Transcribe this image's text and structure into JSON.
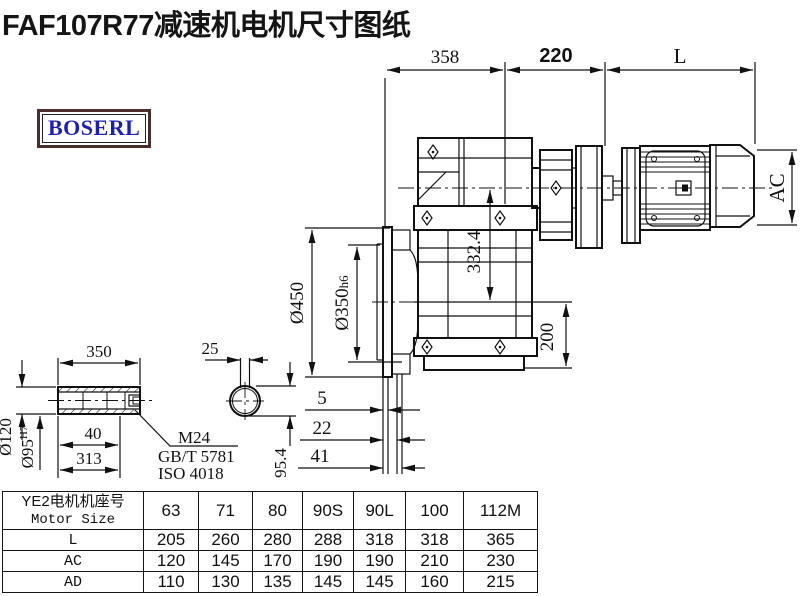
{
  "title": "FAF107R77减速机电机尺寸图纸",
  "logo": "BOSERL",
  "drawing": {
    "dims": {
      "top_width": "358",
      "top_mid": "220",
      "motor_len": "L",
      "motor_od": "AC",
      "axis_dist": "332.4",
      "base_height": "200",
      "flange_od": "Ø450",
      "spigot_base": "Ø350",
      "spigot_tol": "h6",
      "stack": [
        "5",
        "22",
        "41"
      ]
    },
    "shaft": {
      "length": "350",
      "key_width": "25",
      "od": "Ø120",
      "bore_base": "Ø95",
      "bore_tol": "H7",
      "dim40": "40",
      "dim313": "313",
      "key_dim": "95.4",
      "thread": "M24",
      "std_gb": "GB/T 5781",
      "std_iso": "ISO 4018"
    }
  },
  "table": {
    "header": {
      "line1": "YE2电机机座号",
      "line2": "Motor Size"
    },
    "columns": [
      "63",
      "71",
      "80",
      "90S",
      "90L",
      "100",
      "112M"
    ],
    "rows": [
      {
        "label": "L",
        "values": [
          "205",
          "260",
          "280",
          "288",
          "318",
          "318",
          "365"
        ]
      },
      {
        "label": "AC",
        "values": [
          "120",
          "145",
          "170",
          "190",
          "190",
          "210",
          "230"
        ]
      },
      {
        "label": "AD",
        "values": [
          "110",
          "130",
          "135",
          "145",
          "145",
          "160",
          "215"
        ]
      }
    ]
  }
}
